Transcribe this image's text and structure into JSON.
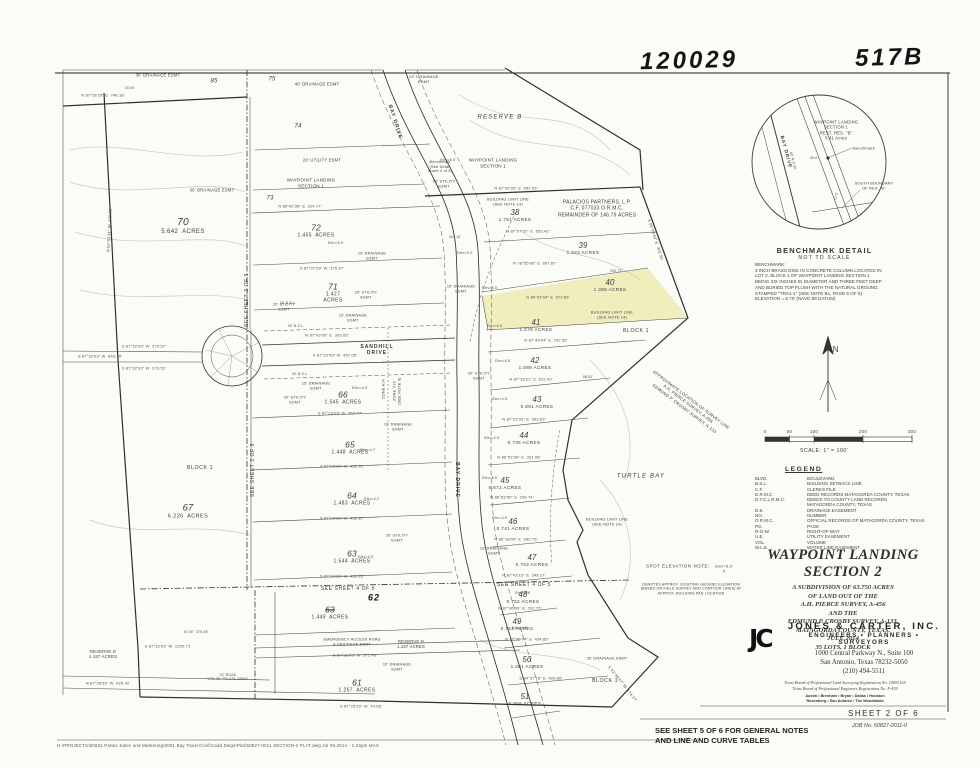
{
  "stamps": {
    "left": "120029",
    "right": "517B"
  },
  "colors": {
    "lot_highlight": "#f1eebe",
    "ink": "#3d3d3d"
  },
  "lots": [
    {
      "num": "70",
      "acres": "5.642  ACRES",
      "x": 183,
      "y": 227,
      "s": 6
    },
    {
      "num": "72",
      "acres": "1.455  ACRES",
      "x": 316,
      "y": 231,
      "s": 5
    },
    {
      "num": "71",
      "acres": "1.427\nACRES",
      "x": 333,
      "y": 293,
      "s": 5
    },
    {
      "num": "67",
      "acres": "6.226  ACRES",
      "x": 188,
      "y": 512,
      "s": 5.5
    },
    {
      "num": "38",
      "acres": "1.751 ACRES",
      "x": 515,
      "y": 216,
      "s": 4.6
    },
    {
      "num": "39",
      "acres": "1.323 ACRES",
      "x": 583,
      "y": 249,
      "s": 4.6
    },
    {
      "num": "40",
      "acres": "1.388 ACRES",
      "x": 610,
      "y": 286,
      "s": 4.6
    },
    {
      "num": "41",
      "acres": "1.578 ACRES",
      "x": 536,
      "y": 326,
      "s": 4.6
    },
    {
      "num": "42",
      "acres": "1.089 ACRES",
      "x": 535,
      "y": 364,
      "s": 4.6
    },
    {
      "num": "43",
      "acres": "0.881 ACRES",
      "x": 537,
      "y": 403,
      "s": 4.6
    },
    {
      "num": "44",
      "acres": "0.736 ACRES",
      "x": 524,
      "y": 439,
      "s": 4.6
    },
    {
      "num": "45",
      "acres": "0.672 ACRES",
      "x": 505,
      "y": 484,
      "s": 4.6
    },
    {
      "num": "46",
      "acres": "0.741 ACRES",
      "x": 513,
      "y": 525,
      "s": 4.6
    },
    {
      "num": "47",
      "acres": "0.753 ACRES",
      "x": 532,
      "y": 561,
      "s": 4.6
    },
    {
      "num": "48",
      "acres": "0.752 ACRES",
      "x": 523,
      "y": 598,
      "s": 4.6
    },
    {
      "num": "49",
      "acres": "0.751 ACRES",
      "x": 517,
      "y": 625,
      "s": 4.6
    },
    {
      "num": "50",
      "acres": "1.301 ACRES",
      "x": 527,
      "y": 663,
      "s": 4.6
    },
    {
      "num": "51",
      "acres": "0.968 ACRES",
      "x": 525,
      "y": 700,
      "s": 4.6
    },
    {
      "num": "66",
      "acres": "1.545  ACRES",
      "x": 343,
      "y": 398,
      "s": 5
    },
    {
      "num": "65",
      "acres": "1.448  ACRES",
      "x": 350,
      "y": 448,
      "s": 5
    },
    {
      "num": "64",
      "acres": "1.483  ACRES",
      "x": 352,
      "y": 499,
      "s": 5
    },
    {
      "num": "63",
      "acres": "1.544  ACRES",
      "x": 352,
      "y": 557,
      "s": 5
    },
    {
      "num": "63",
      "acres": "1.449  ACRES",
      "x": 330,
      "y": 613,
      "s": 5,
      "struck": true
    },
    {
      "num": "61",
      "acres": "1.267  ACRES",
      "x": 357,
      "y": 686,
      "s": 5
    }
  ],
  "map_labels": [
    {
      "t": "30' DRAINAGE ESMT",
      "x": 158,
      "y": 75,
      "s": 4.2
    },
    {
      "t": "85",
      "x": 214,
      "y": 82,
      "s": 6,
      "c": "lotsolo"
    },
    {
      "t": "75",
      "x": 272,
      "y": 80,
      "s": 6,
      "c": "lotsolo"
    },
    {
      "t": "40' DRAINAGE ESMT",
      "x": 317,
      "y": 84,
      "s": 4.2
    },
    {
      "t": "22' DRAINAGE\nESMT",
      "x": 424,
      "y": 79,
      "s": 4
    },
    {
      "t": "N 87°28'29\" E  748.18'",
      "x": 103,
      "y": 96,
      "s": 3.9,
      "c": "dim"
    },
    {
      "t": "15.00'",
      "x": 130,
      "y": 88,
      "s": 3.4,
      "c": "dim"
    },
    {
      "t": "74",
      "x": 298,
      "y": 127,
      "s": 6,
      "c": "lotsolo"
    },
    {
      "t": "BAY DRIVE",
      "x": 395,
      "y": 122,
      "r": 72,
      "s": 5,
      "c": "roadlbl"
    },
    {
      "t": "RESERVE B",
      "x": 500,
      "y": 118,
      "s": 6,
      "c": "resv"
    },
    {
      "t": "20' UTILITY ESMT",
      "x": 322,
      "y": 160,
      "s": 4.2
    },
    {
      "t": "WAYPOINT LANDING\nSECTION 1",
      "x": 311,
      "y": 183,
      "s": 4.6
    },
    {
      "t": "WAYPOINT LANDING\nSECTION 1",
      "x": 493,
      "y": 163,
      "s": 4.6
    },
    {
      "t": "Benchmark\n(See Detail\nSheet 4 of 5)",
      "x": 440,
      "y": 167,
      "s": 3.8
    },
    {
      "t": "20' UTILITY\nESMT",
      "x": 444,
      "y": 184,
      "s": 3.8
    },
    {
      "t": "73",
      "x": 270,
      "y": 199,
      "s": 6,
      "c": "lotsolo"
    },
    {
      "t": "N 85°42'36\" E  314.77'",
      "x": 300,
      "y": 207,
      "s": 3.9,
      "c": "dim"
    },
    {
      "t": "N 87°42'26\" E  652.05'",
      "x": 516,
      "y": 189,
      "s": 3.9,
      "c": "dim"
    },
    {
      "t": "PALACIOS PARTNERS, L.P.\nC.F. 077033 O.R.M.C.\nREMAINDER OF 146.79 ACRES",
      "x": 597,
      "y": 209,
      "s": 5
    },
    {
      "t": "BUILDING LIMIT LINE\n(SEE NOTE 14)",
      "x": 508,
      "y": 202,
      "s": 3.8
    },
    {
      "t": "263.13'",
      "x": 455,
      "y": 237,
      "s": 3.4,
      "c": "dim"
    },
    {
      "t": "N 87°07'37\" E  653.42'",
      "x": 528,
      "y": 232,
      "s": 3.9,
      "c": "dim"
    },
    {
      "t": "N 78°55'06\" E  657.87'",
      "x": 535,
      "y": 264,
      "s": 3.9,
      "c": "dim"
    },
    {
      "t": "343.73'",
      "x": 616,
      "y": 271,
      "s": 3.4,
      "c": "dim"
    },
    {
      "t": "10' DRAINAGE\nESMT",
      "x": 461,
      "y": 289,
      "s": 3.8
    },
    {
      "t": "N 86°54'04\" E  679.85'",
      "x": 548,
      "y": 298,
      "s": 3.9,
      "c": "dim"
    },
    {
      "t": "BUILDING LIMIT LINE\n(SEE NOTE 14)",
      "x": 612,
      "y": 315,
      "s": 3.8
    },
    {
      "t": "BLOCK 1",
      "x": 636,
      "y": 331,
      "s": 5.2,
      "c": "blk"
    },
    {
      "t": "N 87°43'04\" E  702.55'",
      "x": 546,
      "y": 341,
      "s": 3.9,
      "c": "dim"
    },
    {
      "t": "20' UTILITY\nESMT",
      "x": 479,
      "y": 376,
      "s": 3.8
    },
    {
      "t": "N 87°18'21\" E  612.03'",
      "x": 531,
      "y": 380,
      "s": 3.9,
      "c": "dim"
    },
    {
      "t": "98.52'",
      "x": 588,
      "y": 377,
      "s": 3.4,
      "c": "dim"
    },
    {
      "t": "N 87°29'31\" E  353.53'",
      "x": 524,
      "y": 420,
      "s": 3.9,
      "c": "dim"
    },
    {
      "t": "N 86°53'30\" E  331.58'",
      "x": 519,
      "y": 458,
      "s": 3.9,
      "c": "dim"
    },
    {
      "t": "N 86°53'50\" E  299.74'",
      "x": 512,
      "y": 498,
      "s": 3.9,
      "c": "dim"
    },
    {
      "t": "N 86°18'09\" E  330.76'",
      "x": 516,
      "y": 540,
      "s": 3.9,
      "c": "dim"
    },
    {
      "t": "10' DRAINAGE\nESMT",
      "x": 494,
      "y": 551,
      "s": 3.8
    },
    {
      "t": "N 87°43'13\" E  348.27'",
      "x": 524,
      "y": 576,
      "s": 3.9,
      "c": "dim"
    },
    {
      "t": "SEE SHEET 4 OF 5",
      "x": 524,
      "y": 585,
      "s": 5,
      "c": "blk"
    },
    {
      "t": "N 87°36'09\" E  292.75'",
      "x": 520,
      "y": 609,
      "s": 3.9,
      "c": "dim"
    },
    {
      "t": "N 87°36'04\" E  434.85'",
      "x": 527,
      "y": 640,
      "s": 3.9,
      "c": "dim"
    },
    {
      "t": "35' DRAINAGE ESMT",
      "x": 607,
      "y": 659,
      "s": 3.8
    },
    {
      "t": "S 84°37'16\" E  429.86'",
      "x": 541,
      "y": 679,
      "s": 3.9,
      "c": "dim"
    },
    {
      "t": "BLOCK 1",
      "x": 605,
      "y": 681,
      "s": 5.2,
      "c": "blk"
    },
    {
      "t": "SPOT ELEVATION NOTE:",
      "x": 678,
      "y": 566,
      "s": 4.4,
      "c": "blk"
    },
    {
      "t": "Elev=6.3'\nX",
      "x": 724,
      "y": 569,
      "s": 3.8
    },
    {
      "t": "DENOTES APPROX. EXISTING GROUND ELEVATION\n(BASED ON FIELD SURVEY AND CONTOUR LINES) AT\nAPPROX. BUILDING PAD LOCATION",
      "x": 691,
      "y": 589,
      "s": 3.6
    },
    {
      "t": "TURTLE BAY",
      "x": 641,
      "y": 477,
      "s": 6,
      "c": "resv"
    },
    {
      "t": "APPROXIMATE LOCATION OF SURVEY LINE\nA.H. PIERCE SURVEY, A-456\nEDMUND P. CROSBY SURVEY, A-133",
      "x": 688,
      "y": 404,
      "r": 37,
      "s": 4.2
    },
    {
      "t": "S 42°36'27\" W  174.27'",
      "x": 622,
      "y": 684,
      "r": 52,
      "s": 3.9,
      "c": "dim"
    },
    {
      "t": "BUILDING LIMIT LINE\n(SEE NOTE 14)",
      "x": 607,
      "y": 522,
      "s": 3.8
    },
    {
      "t": "BAY DRIVE",
      "x": 457,
      "y": 480,
      "r": 90,
      "s": 5,
      "c": "roadlbl"
    },
    {
      "t": "ZONE A14",
      "x": 384,
      "y": 389,
      "r": -90,
      "s": 3.8
    },
    {
      "t": "ZONE V19\n(SEE NOTE 9)",
      "x": 397,
      "y": 391,
      "r": -90,
      "s": 3.8
    },
    {
      "t": "SANDHILL\nDRIVE",
      "x": 377,
      "y": 350,
      "s": 5,
      "c": "roadlbl"
    },
    {
      "t": "N 87°03'03\" E  393.05'",
      "x": 327,
      "y": 336,
      "s": 3.9,
      "c": "dim"
    },
    {
      "t": "S 87°32'03\" W  457.05'",
      "x": 335,
      "y": 356,
      "s": 3.9,
      "c": "dim"
    },
    {
      "t": "25' B.S.L.",
      "x": 296,
      "y": 326,
      "s": 3.4,
      "c": "dim"
    },
    {
      "t": "25' B.S.L.",
      "x": 300,
      "y": 374,
      "s": 3.4,
      "c": "dim"
    },
    {
      "t": "20' UTILITY\nESMT",
      "x": 284,
      "y": 307,
      "s": 3.8
    },
    {
      "t": "20' UTILITY\nESMT",
      "x": 295,
      "y": 400,
      "s": 3.8
    },
    {
      "t": "10' DRAINAGE\nESMT",
      "x": 353,
      "y": 318,
      "s": 3.8
    },
    {
      "t": "15' DRAINAGE\nESMT",
      "x": 316,
      "y": 386,
      "s": 3.8
    },
    {
      "t": "S 87°23'29\" W  452.77'",
      "x": 340,
      "y": 414,
      "s": 3.9,
      "c": "dim"
    },
    {
      "t": "10' DRAINAGE\nESMT",
      "x": 398,
      "y": 427,
      "s": 3.8
    },
    {
      "t": "S 87°03'39\" W  452.91'",
      "x": 342,
      "y": 467,
      "s": 3.9,
      "c": "dim"
    },
    {
      "t": "BLOCK 1",
      "x": 200,
      "y": 468,
      "s": 5.2,
      "c": "blk"
    },
    {
      "t": "S 87°23'29\" W  452.87'",
      "x": 342,
      "y": 519,
      "s": 3.9,
      "c": "dim"
    },
    {
      "t": "20' UTILITY\nESMT",
      "x": 397,
      "y": 538,
      "s": 3.8
    },
    {
      "t": "S 87°23'29\" W  452.85'",
      "x": 342,
      "y": 577,
      "s": 3.9,
      "c": "dim"
    },
    {
      "t": "SEE SHEET 4 OF 5",
      "x": 348,
      "y": 589,
      "s": 5,
      "c": "blk"
    },
    {
      "t": "62",
      "x": 374,
      "y": 598,
      "s": 9,
      "c": "handw"
    },
    {
      "t": "EMERGENCY ACCESS ROAD\n& DRAINAGE ESMT",
      "x": 352,
      "y": 642,
      "s": 3.8
    },
    {
      "t": "RESERVE D\n1.187 ACRES",
      "x": 411,
      "y": 644,
      "s": 4.2
    },
    {
      "t": "S 87°32'03\" W  371.45'",
      "x": 355,
      "y": 656,
      "s": 3.9,
      "c": "dim"
    },
    {
      "t": "10' DRAINAGE\nESMT",
      "x": 397,
      "y": 667,
      "s": 3.8
    },
    {
      "t": "S 87°25'29\" W  74.58'",
      "x": 361,
      "y": 707,
      "s": 3.9,
      "c": "dim"
    },
    {
      "t": "40.00'  376.55'",
      "x": 196,
      "y": 632,
      "s": 3.4,
      "c": "dim"
    },
    {
      "t": "S 87°32'03\" W  1250.71'",
      "x": 168,
      "y": 647,
      "s": 3.9,
      "c": "dim"
    },
    {
      "t": "RESERVE D\n1.187 ACRES",
      "x": 103,
      "y": 654,
      "s": 4.2
    },
    {
      "t": "N 87°28'36\" W  625.42'",
      "x": 108,
      "y": 684,
      "s": 3.9,
      "c": "dim"
    },
    {
      "t": "32' ROAD\nVOL.35, PG.178, DRMC",
      "x": 228,
      "y": 677,
      "s": 3.4,
      "c": "dim"
    },
    {
      "t": "S 87°07'29\" W  375.97'",
      "x": 322,
      "y": 269,
      "s": 3.9,
      "c": "dim"
    },
    {
      "t": "20' B.S.L.",
      "x": 288,
      "y": 303,
      "s": 3.4,
      "c": "dim"
    },
    {
      "t": "10' DRAINAGE\nESMT",
      "x": 372,
      "y": 256,
      "s": 3.8
    },
    {
      "t": "20' UTILITY\nESMT",
      "x": 366,
      "y": 295,
      "s": 3.8
    },
    {
      "t": "30' DRAINAGE ESMT",
      "x": 212,
      "y": 190,
      "s": 4.2
    },
    {
      "t": "SEE SHEET 3 OF 5",
      "x": 247,
      "y": 300,
      "r": -90,
      "s": 5,
      "c": "blk"
    },
    {
      "t": "SEE SHEET 3 OF 5",
      "x": 253,
      "y": 470,
      "r": -90,
      "s": 5,
      "c": "blk"
    },
    {
      "t": "N 02°51'41\" W  439.31'",
      "x": 110,
      "y": 230,
      "r": -87,
      "s": 3.9,
      "c": "dim"
    },
    {
      "t": "S 05°08'44\" E  302.56'",
      "x": 655,
      "y": 240,
      "r": 72,
      "s": 3.9,
      "c": "dim"
    },
    {
      "t": "S 87°32'03\" W  279.57'",
      "x": 144,
      "y": 347,
      "s": 3.9,
      "c": "dim"
    },
    {
      "t": "S 87°32'03\" W  843.36'",
      "x": 100,
      "y": 357,
      "s": 3.9,
      "c": "dim"
    },
    {
      "t": "S 87°32'03\" W  279.51'",
      "x": 144,
      "y": 369,
      "s": 3.9,
      "c": "dim"
    },
    {
      "t": "Elev=6.5'",
      "x": 336,
      "y": 243,
      "s": 3.4,
      "c": "dim"
    },
    {
      "t": "Elev=6.5'",
      "x": 448,
      "y": 160,
      "s": 3.4,
      "c": "dim"
    },
    {
      "t": "Elev=6.3'",
      "x": 465,
      "y": 253,
      "s": 3.4,
      "c": "dim"
    },
    {
      "t": "Elev=5.5'",
      "x": 490,
      "y": 288,
      "s": 3.4,
      "c": "dim"
    },
    {
      "t": "Elev=6.5'",
      "x": 495,
      "y": 326,
      "s": 3.4,
      "c": "dim"
    },
    {
      "t": "Elev=6.5'",
      "x": 503,
      "y": 361,
      "s": 3.4,
      "c": "dim"
    },
    {
      "t": "Elev=4.5'",
      "x": 500,
      "y": 399,
      "s": 3.4,
      "c": "dim"
    },
    {
      "t": "Elev=4.5'",
      "x": 492,
      "y": 438,
      "s": 3.4,
      "c": "dim"
    },
    {
      "t": "Elev=6.5'",
      "x": 490,
      "y": 478,
      "s": 3.4,
      "c": "dim"
    },
    {
      "t": "Elev=4.5'",
      "x": 500,
      "y": 518,
      "s": 3.4,
      "c": "dim"
    },
    {
      "t": "Elev=4.5'",
      "x": 360,
      "y": 388,
      "s": 3.4,
      "c": "dim"
    },
    {
      "t": "Elev=4.7'",
      "x": 368,
      "y": 450,
      "s": 3.4,
      "c": "dim"
    },
    {
      "t": "Elev=4.2'",
      "x": 372,
      "y": 499,
      "s": 3.4,
      "c": "dim"
    },
    {
      "t": "Elev=4.5'",
      "x": 366,
      "y": 557,
      "s": 3.4,
      "c": "dim"
    },
    {
      "t": "Elev=6.6'",
      "x": 523,
      "y": 593,
      "s": 3.4,
      "c": "dim"
    },
    {
      "t": "Elev=4.6'",
      "x": 520,
      "y": 628,
      "s": 3.4,
      "c": "dim"
    },
    {
      "t": "WAYPOINT LANDING\nSECTION 1\nREST. RES. \"B\"\n5.41 Acres",
      "x": 836,
      "y": 130,
      "s": 4.2
    },
    {
      "t": "Benchmark",
      "x": 864,
      "y": 148,
      "s": 4
    },
    {
      "t": "45.6'",
      "x": 814,
      "y": 158,
      "s": 3.4,
      "c": "dim"
    },
    {
      "t": "BAY DRIVE",
      "x": 786,
      "y": 152,
      "r": 75,
      "s": 4.6,
      "c": "roadlbl"
    },
    {
      "t": "60' R.O.W.",
      "x": 793,
      "y": 161,
      "r": 75,
      "s": 3.4,
      "c": "dim"
    },
    {
      "t": "SOUTH BOUNDARY\nOF RES. \"B\"",
      "x": 874,
      "y": 186,
      "s": 3.8
    },
    {
      "t": "21.6'",
      "x": 836,
      "y": 196,
      "r": -80,
      "s": 3.2,
      "c": "dim"
    },
    {
      "t": "N",
      "x": 836,
      "y": 350,
      "s": 8,
      "c": "blk"
    }
  ],
  "benchmark_detail": {
    "title": "BENCHMARK DETAIL",
    "subtitle": "NOT TO SCALE",
    "note": "BENCHMARK:\n3 INCH BRASS DISK IN CONCRETE COLUMN LOCATED IN\nLOT 2, BLOCK 1 OF WAYPOINT LANDING SECTION 1\nBEING SIX INCHES IN DIAMETER AND THREE FEET DEEP\nAND BURIED TOP FLUSH WITH THE NATURAL GROUND.\nSTAMPED \"TRS1-1\" (SEE NOTE B1, PAGE 5 OF 5)\nELEVATION = 6.70' (NAVD 88 DATUM)"
  },
  "scale_bar": {
    "ticks": [
      "0",
      "50",
      "100",
      "200",
      "300"
    ],
    "caption": "SCALE: 1\" = 100'"
  },
  "legend": {
    "title": "LEGEND",
    "items": [
      {
        "abbr": "BLVD.",
        "def": "BOULEVARD"
      },
      {
        "abbr": "B.S.L.",
        "def": "BUILDING SETBACK LINE"
      },
      {
        "abbr": "C.F.",
        "def": "CLERKS FILE"
      },
      {
        "abbr": "D.R.M.C.",
        "def": "DEED RECORDS MATAGORDA COUNTY, TEXAS"
      },
      {
        "abbr": "D.T.C.L.R.M.C.",
        "def": "DEEDS TO COUNTY LAND RECORDS\nMATAGORDA COUNTY, TEXAS"
      },
      {
        "abbr": "D.E.",
        "def": "DRAINAGE EASEMENT"
      },
      {
        "abbr": "NO.",
        "def": "NUMBER"
      },
      {
        "abbr": "O.R.M.C.",
        "def": "OFFICIAL RECORDS OF MATAGORDA COUNTY, TEXAS"
      },
      {
        "abbr": "PG.",
        "def": "PAGE"
      },
      {
        "abbr": "R-O-W",
        "def": "RIGHT-OF-WAY"
      },
      {
        "abbr": "U.E.",
        "def": "UTILITY EASEMENT"
      },
      {
        "abbr": "VOL.",
        "def": "VOLUME"
      },
      {
        "abbr": "W.L.E.",
        "def": "WATER LINE EASEMENT"
      }
    ]
  },
  "title_block": {
    "title": "WAYPOINT  LANDING  SECTION  2",
    "description": "A SUBDIVISION OF 63.750 ACRES\nOF LAND OUT OF THE\nA.H. PIERCE SURVEY, A-456\nAND THE\nEDMUND P. CROSBY SURVEY, A-133,\nMATAGORDA COUNTY, TEXAS.\nJULY, 2014\n35 LOTS, 1 BLOCK"
  },
  "firm": {
    "logo": "JC",
    "name": "JONES & CARTER, INC.",
    "tagline": "ENGINEERS • PLANNERS • SURVEYORS",
    "address1": "1000 Central Parkway N., Suite 100",
    "address2": "San Antonio, Texas 78232-5050",
    "phone": "(210) 494-5511",
    "reg1": "Texas Board of Professional Land Surveying Registration No. 10093105",
    "reg2": "Texas Board of Professional Engineers Registration No. F-439",
    "cities1": "Austin • Brenham • Bryan • Dallas • Houston",
    "cities2": "Rosenberg • San Antonio • The Woodlands"
  },
  "sheet": {
    "label": "SHEET 2 OF 6",
    "job": "JOB No. 50827-0011-0",
    "note": "SEE SHEET 5 OF 6 FOR GENERAL NOTES\nAND LINE AND CURVE TABLES"
  },
  "footer": {
    "path": "H:\\PROJECTS\\50832 Pattas Sales and Marketing\\0001 Bay Tower\\Civil\\Cadd Dwgs\\Plat\\50827-0011 SECTION-2 PLAT.dwg   Jul 09,2014 - 1:24pm MAX"
  }
}
